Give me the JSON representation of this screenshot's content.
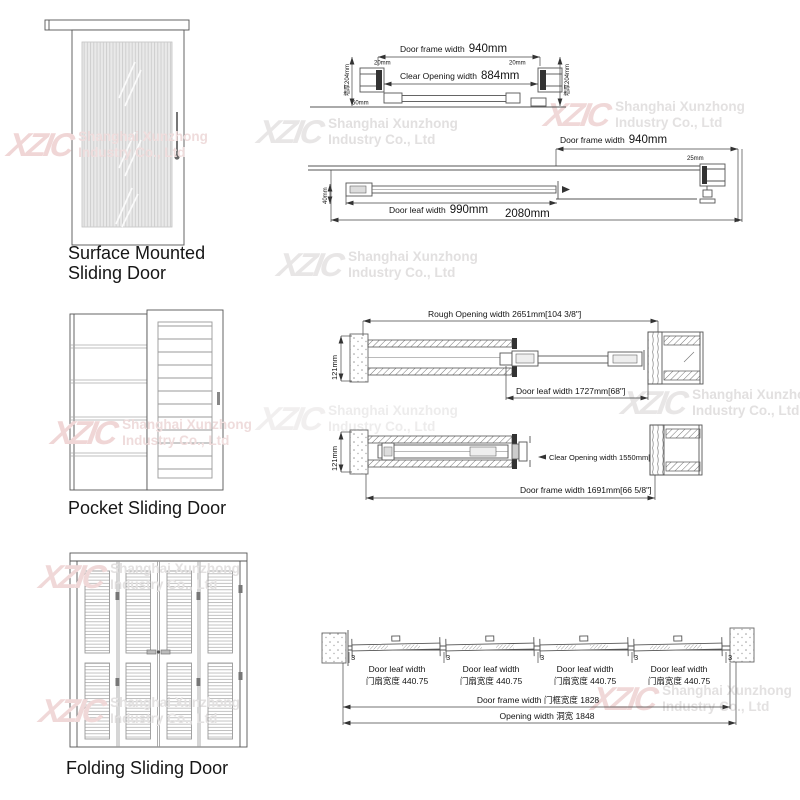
{
  "page": {
    "background": "#ffffff"
  },
  "watermark": {
    "logo": "XZIC",
    "line1": "Shanghai Xunzhong",
    "line2": "Industry Co., Ltd",
    "gray_color": "#e2e0e0",
    "pink_color": "#f0d6d6"
  },
  "door_types": [
    {
      "label_line1": "Surface Mounted",
      "label_line2": "Sliding Door"
    },
    {
      "label": "Pocket Sliding Door"
    },
    {
      "label": "Folding Sliding Door"
    }
  ],
  "drawings": {
    "surface_closed": {
      "frame_label": "Door frame width",
      "frame_value": "940mm",
      "clear_label": "Clear Opening width",
      "clear_value": "884mm",
      "offset_left": "20mm",
      "offset_right": "20mm",
      "wall_left": "墙厚204mm",
      "wall_right": "墙厚204mm",
      "bottom_offset": "50mm"
    },
    "surface_open": {
      "frame_label": "Door frame width",
      "frame_value": "940mm",
      "jamb_offset": "25mm",
      "leaf_label": "Door leaf width",
      "leaf_value": "990mm",
      "total_width": "2080mm",
      "side_offset": "40mm"
    },
    "pocket_closed": {
      "rough_opening": "Rough Opening width 2651mm[104 3/8\"]",
      "wall_thickness": "121mm",
      "leaf_width": "Door leaf width 1727mm[68\"]"
    },
    "pocket_open": {
      "wall_thickness": "121mm",
      "clear_opening": "Clear Opening width 1550mm[61\"]",
      "frame_width": "Door frame width 1691mm[66 5/8\"]"
    },
    "folding": {
      "leaf_label_en": "Door leaf width",
      "leaf_label_cn": "门扇宽度  440.75",
      "gap": "3",
      "frame_width": "Door frame width 门框宽度  1828",
      "opening_width": "Opening width 洞宽 1848"
    }
  }
}
